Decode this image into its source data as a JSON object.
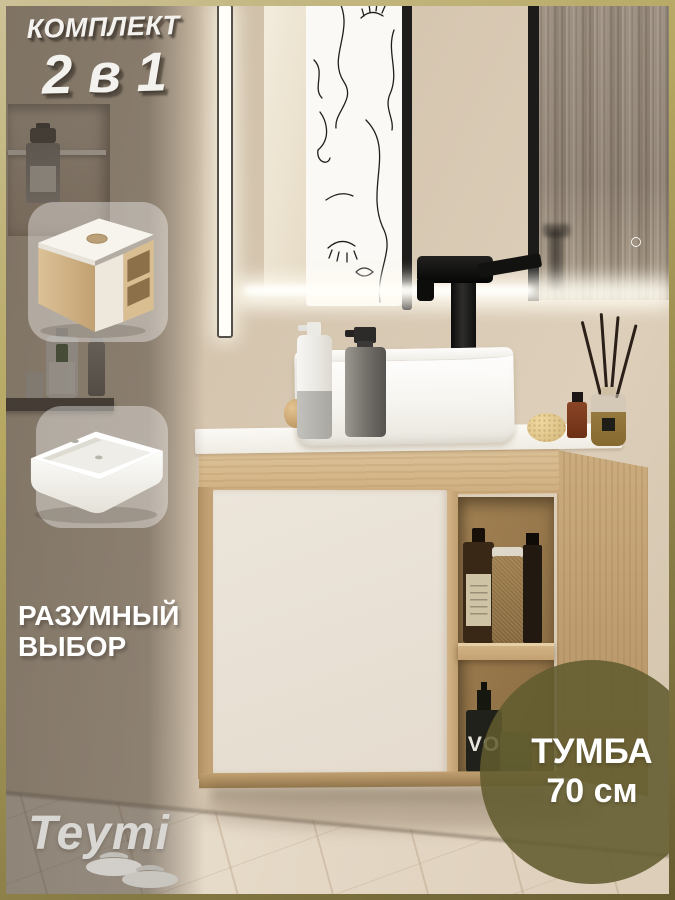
{
  "overlay": {
    "kit": {
      "line1": "КОМПЛЕКТ",
      "line2": "2 в 1"
    },
    "choice": {
      "line1": "РАЗУМНЫЙ",
      "line2": "ВЫБОР"
    },
    "size_badge": {
      "line1": "ТУМБА",
      "line2": "70 см"
    },
    "brand": "Teymi"
  },
  "scene": {
    "bottle_label": "VO",
    "insets": [
      {
        "id": "cabinet-render"
      },
      {
        "id": "sink-render"
      }
    ]
  },
  "colors": {
    "frame_gold_light": "#ccc196",
    "frame_gold_dark": "#665c30",
    "badge_olive": "#615b2e",
    "wall_beige": "#d5c5af",
    "wood_light": "#ddc298",
    "furniture_white": "#ece5da",
    "text_white": "#ffffff",
    "brand_gray": "#d9d7d3"
  }
}
